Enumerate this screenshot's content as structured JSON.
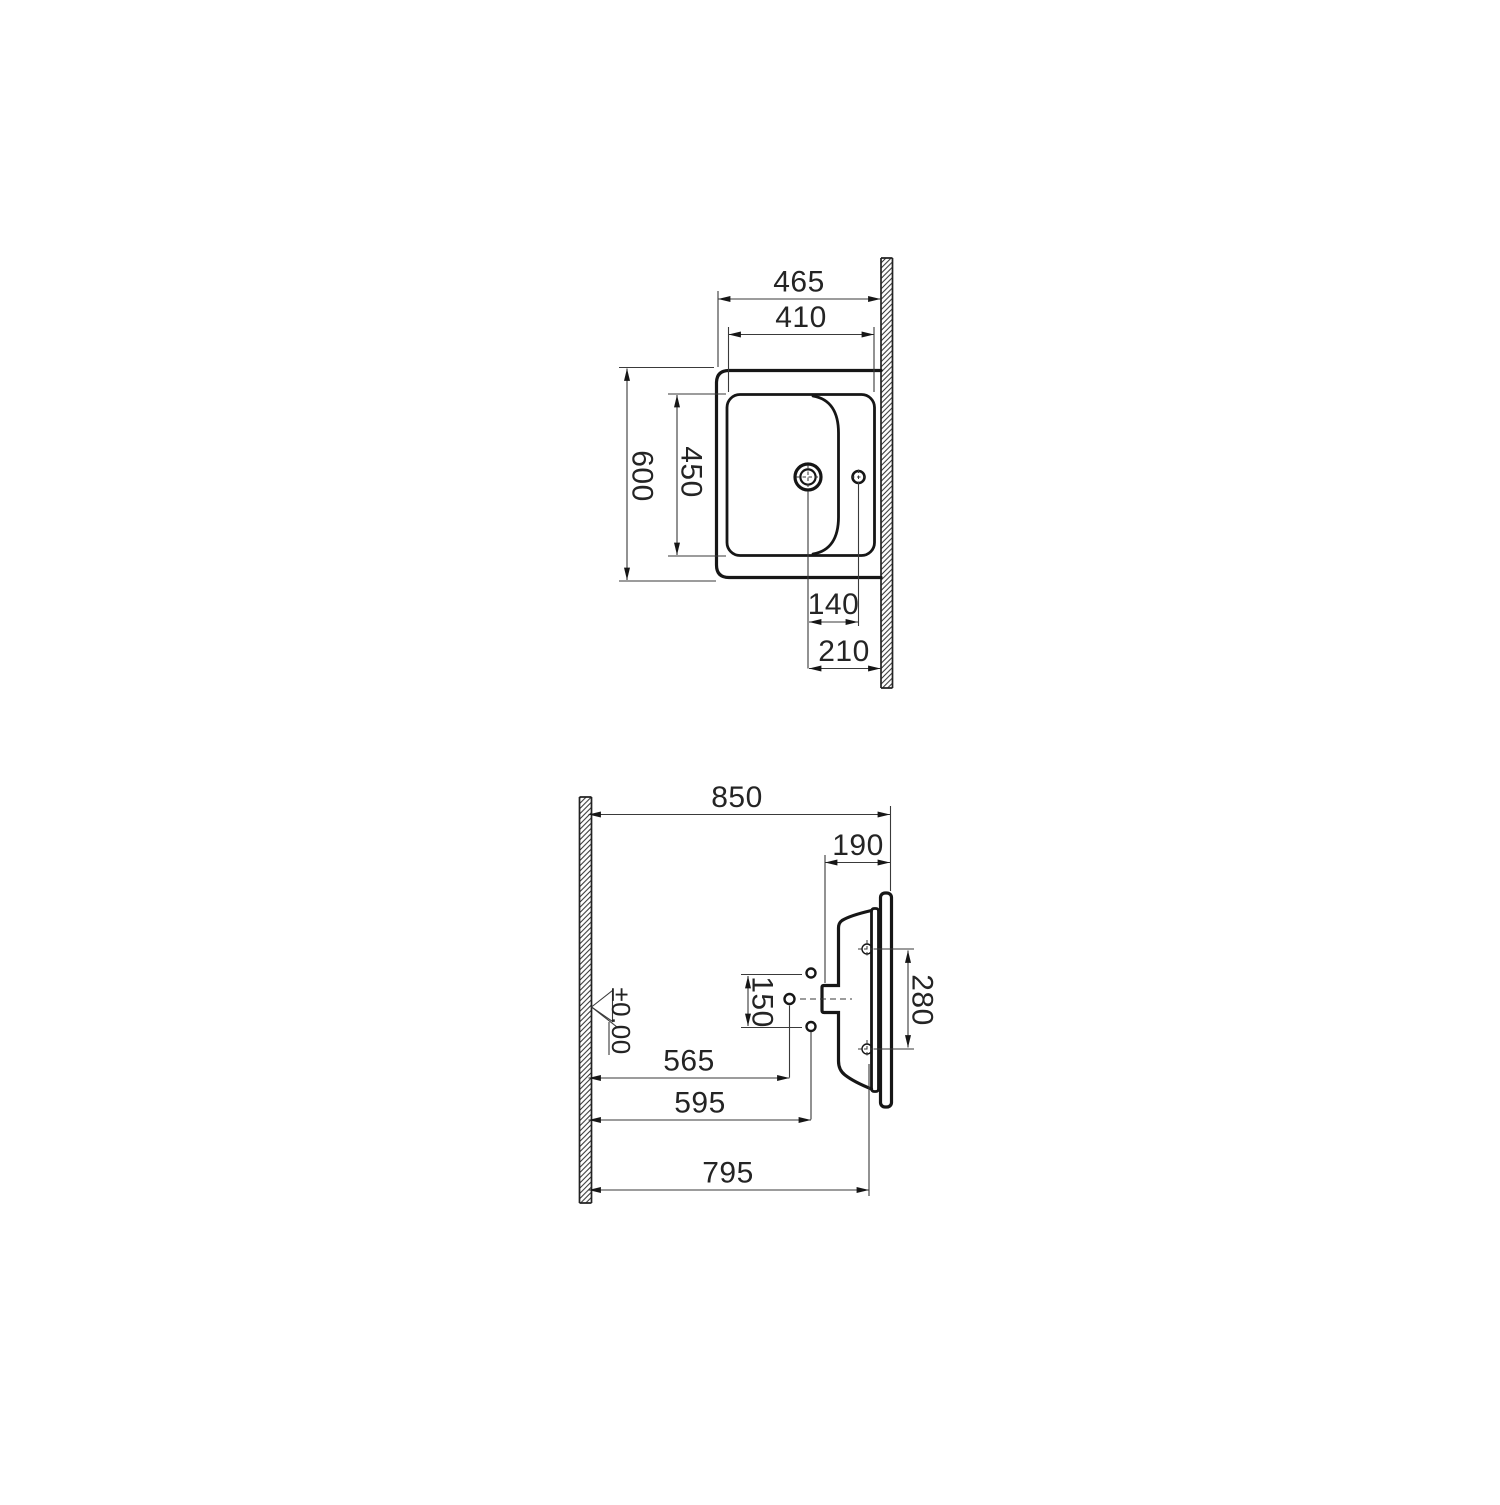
{
  "page": {
    "background": "#ffffff",
    "ink_color": "#161616",
    "text_color": "#242424"
  },
  "plan_view": {
    "overall_width": "465",
    "basin_recess_width": "410",
    "overall_depth": "600",
    "basin_recess_depth": "450",
    "tap_to_drain": "140",
    "drain_to_wall": "210"
  },
  "elevation_view": {
    "overall": "850",
    "rim_section": "190",
    "supply_hole_spacing": "150",
    "fixing_hole_spacing": "280",
    "drain_distance": "565",
    "supply_distance": "595",
    "basin_back_distance": "795",
    "datum_label": "±0.00"
  }
}
